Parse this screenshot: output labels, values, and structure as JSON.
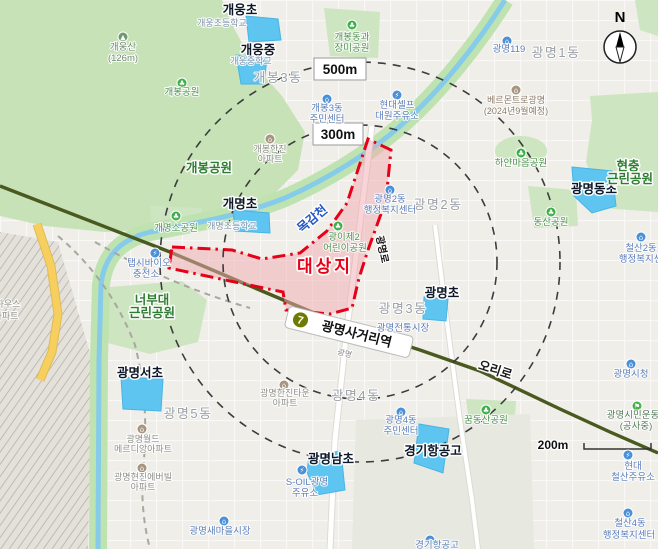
{
  "colors": {
    "site_red": "#e60018",
    "site_fill": "#f2a9b2",
    "school_zone": "#5ec4f0",
    "water": "#86cbe9",
    "stream_band": "#bfe3b0",
    "green": "#cde5c0",
    "green_dark": "#2e7d32",
    "road_dark": "#49591f",
    "road_yellow": "#f7cf5f",
    "line7_olive": "#6e7b00",
    "district_gray": "#9aa0a6",
    "poi_blue": "#5b7db8",
    "park_green": "#3faf49",
    "apartment_brown": "#a79580",
    "dash_gray": "#3c3c3c"
  },
  "site": {
    "label": "대상지"
  },
  "radius": {
    "r500": "500m",
    "r300": "300m"
  },
  "scale_bar": {
    "label": "200m"
  },
  "compass": {
    "label": "N"
  },
  "station": {
    "line": "7",
    "name": "광명사거리역",
    "sub": "광명"
  },
  "map": {
    "labels": [
      {
        "t": "개웅초",
        "x": 240,
        "y": 14,
        "c": "school",
        "n": "label-gaeung-elementary"
      },
      {
        "t": "개웅초등학교",
        "x": 222,
        "y": 26,
        "c": "ssub"
      },
      {
        "t": "개웅중",
        "x": 258,
        "y": 54,
        "c": "school",
        "n": "label-gaeung-middle"
      },
      {
        "t": "개웅중학교",
        "x": 251,
        "y": 64,
        "c": "ssub"
      },
      {
        "t": "개명초",
        "x": 240,
        "y": 208,
        "c": "school",
        "n": "label-gaemyeong-elementary"
      },
      {
        "t": "개명초등학교",
        "x": 232,
        "y": 229,
        "c": "ssub"
      },
      {
        "t": "광명동초",
        "x": 594,
        "y": 193,
        "c": "school",
        "n": "label-gwangmyeongdong-elementary"
      },
      {
        "t": "광명초",
        "x": 442,
        "y": 297,
        "c": "school",
        "n": "label-gwangmyeong-elementary"
      },
      {
        "t": "광명서초",
        "x": 140,
        "y": 377,
        "c": "school",
        "n": "label-gwangmyeongseo-elementary"
      },
      {
        "t": "광명남초",
        "x": 331,
        "y": 463,
        "c": "school",
        "n": "label-gwangmyeongnam-elementary"
      },
      {
        "t": "경기항공고",
        "x": 433,
        "y": 455,
        "c": "school",
        "n": "label-gyeonggi-aviation-hs"
      },
      {
        "t": "개봉3동",
        "x": 278,
        "y": 82,
        "c": "district"
      },
      {
        "t": "광명1동",
        "x": 556,
        "y": 57,
        "c": "district"
      },
      {
        "t": "광명2동",
        "x": 438,
        "y": 209,
        "c": "district"
      },
      {
        "t": "광명3동",
        "x": 403,
        "y": 313,
        "c": "district"
      },
      {
        "t": "광명4동",
        "x": 356,
        "y": 400,
        "c": "district"
      },
      {
        "t": "광명5동",
        "x": 188,
        "y": 418,
        "c": "district"
      },
      {
        "t": "개봉공원",
        "x": 209,
        "y": 172,
        "c": "parkb",
        "n": "label-gaebong-park"
      },
      {
        "t": "너부대",
        "x": 152,
        "y": 304,
        "c": "parkb",
        "n": "label-neobudae-park"
      },
      {
        "t": "근린공원",
        "x": 152,
        "y": 317,
        "c": "parkb"
      },
      {
        "t": "현충",
        "x": 628,
        "y": 170,
        "c": "parkb",
        "n": "label-hyeonchung-park"
      },
      {
        "t": "근린공원",
        "x": 630,
        "y": 183,
        "c": "parkb"
      },
      {
        "t": "개웅산",
        "x": 123,
        "y": 50,
        "c": "mtn",
        "n": "label-gaeung-mountain"
      },
      {
        "t": "(126m)",
        "x": 123,
        "y": 61,
        "c": "mtn"
      },
      {
        "t": "개봉공원",
        "x": 182,
        "y": 95,
        "c": "park"
      },
      {
        "t": "개봉동과",
        "x": 352,
        "y": 40,
        "c": "park"
      },
      {
        "t": "장미공원",
        "x": 352,
        "y": 51,
        "c": "park"
      },
      {
        "t": "개명소공원",
        "x": 176,
        "y": 231,
        "c": "park"
      },
      {
        "t": "하얀마음공원",
        "x": 521,
        "y": 166,
        "c": "park"
      },
      {
        "t": "동산공원",
        "x": 551,
        "y": 225,
        "c": "park"
      },
      {
        "t": "광이제2",
        "x": 344,
        "y": 240,
        "c": "park"
      },
      {
        "t": "어린이공원",
        "x": 345,
        "y": 251,
        "c": "park"
      },
      {
        "t": "꿈동산공원",
        "x": 486,
        "y": 423,
        "c": "park"
      },
      {
        "t": "광명119",
        "x": 509,
        "y": 52,
        "c": "poi"
      },
      {
        "t": "개봉3동",
        "x": 327,
        "y": 111,
        "c": "poi"
      },
      {
        "t": "주민센터",
        "x": 327,
        "y": 122,
        "c": "poi"
      },
      {
        "t": "현대셀프",
        "x": 397,
        "y": 108,
        "c": "poi"
      },
      {
        "t": "대원주유소",
        "x": 397,
        "y": 119,
        "c": "poi"
      },
      {
        "t": "광명2동",
        "x": 390,
        "y": 202,
        "c": "poi"
      },
      {
        "t": "행정복지센터",
        "x": 390,
        "y": 213,
        "c": "poi"
      },
      {
        "t": "광명전통시장",
        "x": 403,
        "y": 331,
        "c": "poi"
      },
      {
        "t": "철산2동",
        "x": 641,
        "y": 251,
        "c": "poi"
      },
      {
        "t": "행정복지센터",
        "x": 645,
        "y": 262,
        "c": "poi"
      },
      {
        "t": "광명4동",
        "x": 401,
        "y": 423,
        "c": "poi"
      },
      {
        "t": "주민센터",
        "x": 401,
        "y": 434,
        "c": "poi"
      },
      {
        "t": "S-OIL광명",
        "x": 307,
        "y": 485,
        "c": "poi"
      },
      {
        "t": "주유소",
        "x": 305,
        "y": 496,
        "c": "poi"
      },
      {
        "t": "광명새마을시장",
        "x": 220,
        "y": 534,
        "c": "poi"
      },
      {
        "t": "탭시바이오",
        "x": 149,
        "y": 266,
        "c": "poi"
      },
      {
        "t": "충전소",
        "x": 146,
        "y": 277,
        "c": "poi"
      },
      {
        "t": "현대",
        "x": 633,
        "y": 469,
        "c": "poi"
      },
      {
        "t": "철산주유소",
        "x": 633,
        "y": 480,
        "c": "poi"
      },
      {
        "t": "철산4동",
        "x": 630,
        "y": 526,
        "c": "poi"
      },
      {
        "t": "행정복지센터",
        "x": 629,
        "y": 538,
        "c": "poi"
      },
      {
        "t": "광명시청",
        "x": 631,
        "y": 377,
        "c": "poi"
      },
      {
        "t": "경기항공고",
        "x": 437,
        "y": 548,
        "c": "poi"
      },
      {
        "t": "광명시민운동",
        "x": 633,
        "y": 418,
        "c": "sport"
      },
      {
        "t": "(공사중)",
        "x": 636,
        "y": 429,
        "c": "sport"
      },
      {
        "t": "개봉한진",
        "x": 270,
        "y": 152,
        "c": "apt"
      },
      {
        "t": "아파트",
        "x": 270,
        "y": 162,
        "c": "apt"
      },
      {
        "t": "광명한진타운",
        "x": 285,
        "y": 396,
        "c": "apt"
      },
      {
        "t": "아파트",
        "x": 285,
        "y": 406,
        "c": "apt"
      },
      {
        "t": "광명월드",
        "x": 143,
        "y": 442,
        "c": "apt"
      },
      {
        "t": "메르디앙아파트",
        "x": 143,
        "y": 452,
        "c": "apt"
      },
      {
        "t": "광명현진에버빌",
        "x": 143,
        "y": 480,
        "c": "apt"
      },
      {
        "t": "아파트",
        "x": 143,
        "y": 490,
        "c": "apt"
      },
      {
        "t": "하우스",
        "x": 8,
        "y": 307,
        "c": "apt"
      },
      {
        "t": "아파트",
        "x": 6,
        "y": 319,
        "c": "apt"
      },
      {
        "t": "베르몬트로광명",
        "x": 516,
        "y": 103,
        "c": "brown"
      },
      {
        "t": "(2024년9월예정)",
        "x": 516,
        "y": 114,
        "c": "brown"
      },
      {
        "t": "목감천",
        "x": 315,
        "y": 222,
        "c": "stream",
        "r": -40,
        "n": "label-mokgamcheon-stream"
      },
      {
        "t": "오리로",
        "x": 494,
        "y": 374,
        "c": "road",
        "r": 18,
        "n": "label-oriro-road"
      },
      {
        "t": "광명로",
        "x": 379,
        "y": 250,
        "c": "roadsm",
        "r": 78,
        "n": "label-gwangmyeongro-road"
      },
      {
        "t": "광명",
        "x": 344,
        "y": 356,
        "c": "tiny",
        "r": 14
      }
    ],
    "icons": [
      {
        "x": 352,
        "y": 25,
        "c": "#3faf49",
        "g": "♣",
        "n": "park-icon"
      },
      {
        "x": 182,
        "y": 83,
        "c": "#3faf49",
        "g": "♣",
        "n": "park-icon"
      },
      {
        "x": 176,
        "y": 216,
        "c": "#3faf49",
        "g": "♣",
        "n": "park-icon"
      },
      {
        "x": 338,
        "y": 226,
        "c": "#3faf49",
        "g": "♣",
        "n": "park-icon"
      },
      {
        "x": 521,
        "y": 153,
        "c": "#3faf49",
        "g": "♣",
        "n": "park-icon"
      },
      {
        "x": 551,
        "y": 212,
        "c": "#3faf49",
        "g": "♣",
        "n": "park-icon"
      },
      {
        "x": 486,
        "y": 410,
        "c": "#3faf49",
        "g": "♣",
        "n": "park-icon"
      },
      {
        "x": 123,
        "y": 37,
        "c": "#6f9a6b",
        "g": "▲",
        "n": "mountain-icon"
      },
      {
        "x": 507,
        "y": 41,
        "c": "#4a90d9",
        "g": "⌂",
        "n": "fire-station-icon"
      },
      {
        "x": 327,
        "y": 99,
        "c": "#4a90d9",
        "g": "⌂",
        "n": "community-center-icon"
      },
      {
        "x": 390,
        "y": 190,
        "c": "#4a90d9",
        "g": "⌂",
        "n": "community-center-icon"
      },
      {
        "x": 641,
        "y": 237,
        "c": "#4a90d9",
        "g": "⌂",
        "n": "community-center-icon"
      },
      {
        "x": 401,
        "y": 412,
        "c": "#4a90d9",
        "g": "⌂",
        "n": "community-center-icon"
      },
      {
        "x": 224,
        "y": 521,
        "c": "#4a90d9",
        "g": "⌂",
        "n": "market-icon"
      },
      {
        "x": 631,
        "y": 364,
        "c": "#4a90d9",
        "g": "⌂",
        "n": "city-hall-icon"
      },
      {
        "x": 628,
        "y": 513,
        "c": "#4a90d9",
        "g": "⌂",
        "n": "community-center-icon"
      },
      {
        "x": 430,
        "y": 540,
        "c": "#4a90d9",
        "g": "⌂",
        "n": "school-icon"
      },
      {
        "x": 397,
        "y": 95,
        "c": "#4a90d9",
        "g": "⚡",
        "n": "gas-station-icon"
      },
      {
        "x": 302,
        "y": 470,
        "c": "#4a90d9",
        "g": "⚡",
        "n": "gas-station-icon"
      },
      {
        "x": 155,
        "y": 253,
        "c": "#4a90d9",
        "g": "⚡",
        "n": "charging-station-icon"
      },
      {
        "x": 628,
        "y": 455,
        "c": "#4a90d9",
        "g": "⚡",
        "n": "gas-station-icon"
      },
      {
        "x": 270,
        "y": 139,
        "c": "#a79580",
        "g": "⌂",
        "n": "apartment-icon"
      },
      {
        "x": 284,
        "y": 385,
        "c": "#a79580",
        "g": "⌂",
        "n": "apartment-icon"
      },
      {
        "x": 142,
        "y": 429,
        "c": "#a79580",
        "g": "⌂",
        "n": "apartment-icon"
      },
      {
        "x": 142,
        "y": 468,
        "c": "#a79580",
        "g": "⌂",
        "n": "apartment-icon"
      },
      {
        "x": 516,
        "y": 90,
        "c": "#a79580",
        "g": "⌂",
        "n": "construction-site-icon"
      },
      {
        "x": 637,
        "y": 406,
        "c": "#4caf50",
        "g": "⚑",
        "n": "sports-facility-icon"
      }
    ]
  }
}
